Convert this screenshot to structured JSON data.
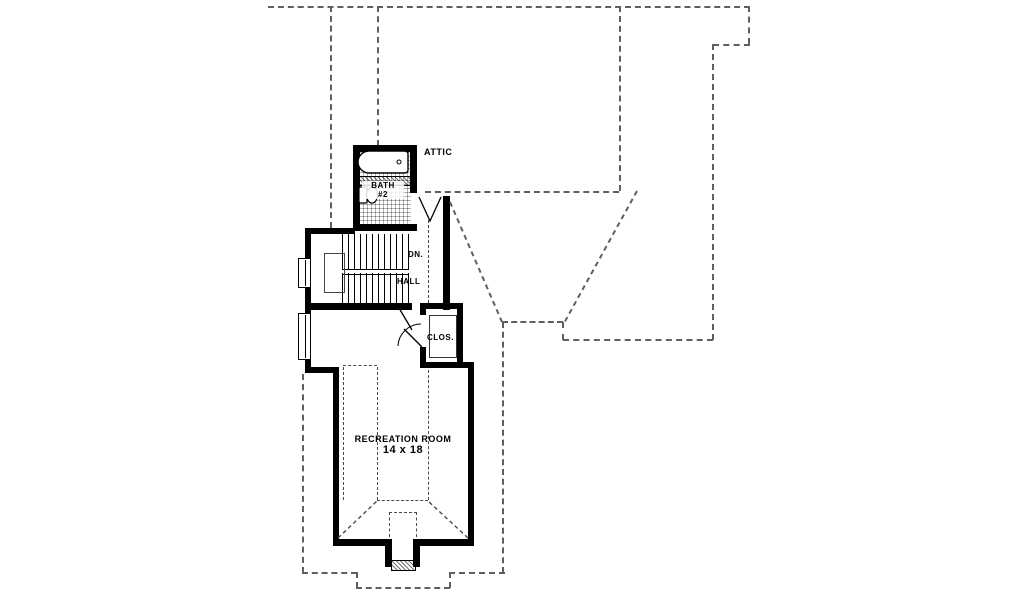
{
  "rooms": {
    "attic": {
      "label": "ATTIC"
    },
    "bath": {
      "label": "BATH",
      "number": "#2"
    },
    "stairs": {
      "direction_label": "DN."
    },
    "hall": {
      "label": "HALL"
    },
    "closet": {
      "label": "CLOS."
    },
    "recreation": {
      "label": "RECREATION ROOM",
      "dimensions": "14 x 18"
    }
  },
  "colors": {
    "wall": "#000000",
    "roof_dash": "#5f5f5f",
    "background": "#ffffff"
  }
}
